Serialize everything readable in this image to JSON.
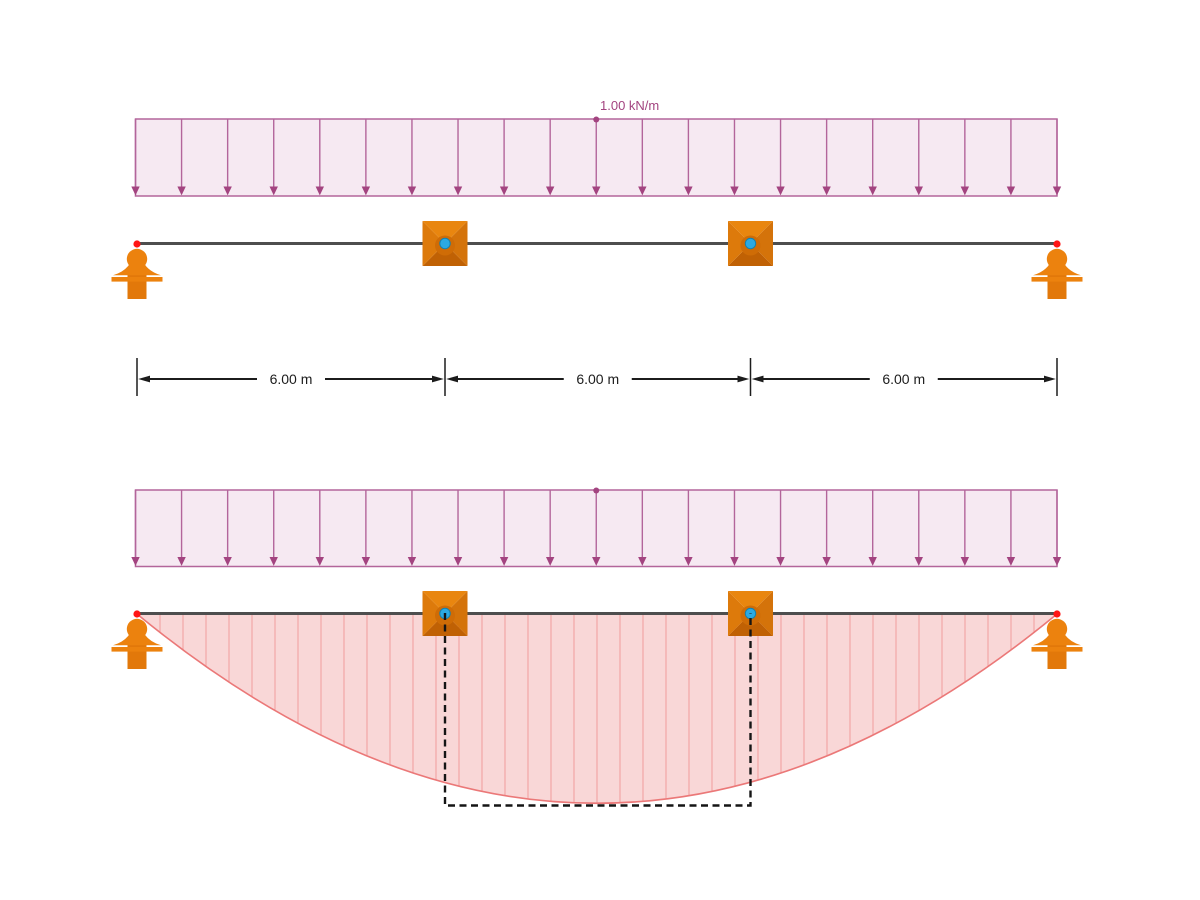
{
  "text": {
    "load_label": "1.00 kN/m",
    "dim_labels": [
      "6.00 m",
      "6.00 m",
      "6.00 m"
    ]
  },
  "model": {
    "distributed_load": "1.00 kN/m",
    "span_labels": [
      "6.00 m",
      "6.00 m",
      "6.00 m"
    ],
    "spans_m": [
      6.0,
      6.0,
      6.0
    ]
  },
  "colors": {
    "background": "#ffffff",
    "load_fill": "#f6e9f2",
    "load_line": "#b3659b",
    "load_arrow": "#a34480",
    "load_text": "#a34480",
    "beam": "#4e4e4e",
    "support_orange": "#ec820e",
    "support_orange_dark": "#e2780a",
    "node_top": "#e9860f",
    "node_left": "#dd7a0b",
    "node_right": "#d4730a",
    "node_bottom": "#c06104",
    "node_hub": "#cf6c06",
    "node_cyan": "#2ba9e2",
    "node_cyan_ring": "#1480ad",
    "node_red": "#ff1515",
    "dim": "#1c1c1c",
    "moment_fill": "#f9d7d7",
    "moment_stroke": "#eb7878",
    "moment_hatch": "#f2a1a1",
    "dashed": "#151515"
  },
  "geometry": {
    "beam_x1": 137,
    "beam_x2": 1057,
    "node_xs": [
      445,
      750.5
    ],
    "arrow_count": 21,
    "top_view": {
      "load_top": 119,
      "load_bottom": 196,
      "beam_y": 243.5,
      "label_x": 600,
      "label_y": 110
    },
    "dims": {
      "line_y": 379,
      "tick_top": 358,
      "tick_bottom": 396,
      "text_dy": 5,
      "text_gap": 34
    },
    "bottom_view": {
      "load_top": 490,
      "load_bottom": 566.5,
      "beam_y": 613.5
    },
    "moment": {
      "apex_depth": 189,
      "hatch_step": 23,
      "box_bottom_y": 805.5
    }
  }
}
